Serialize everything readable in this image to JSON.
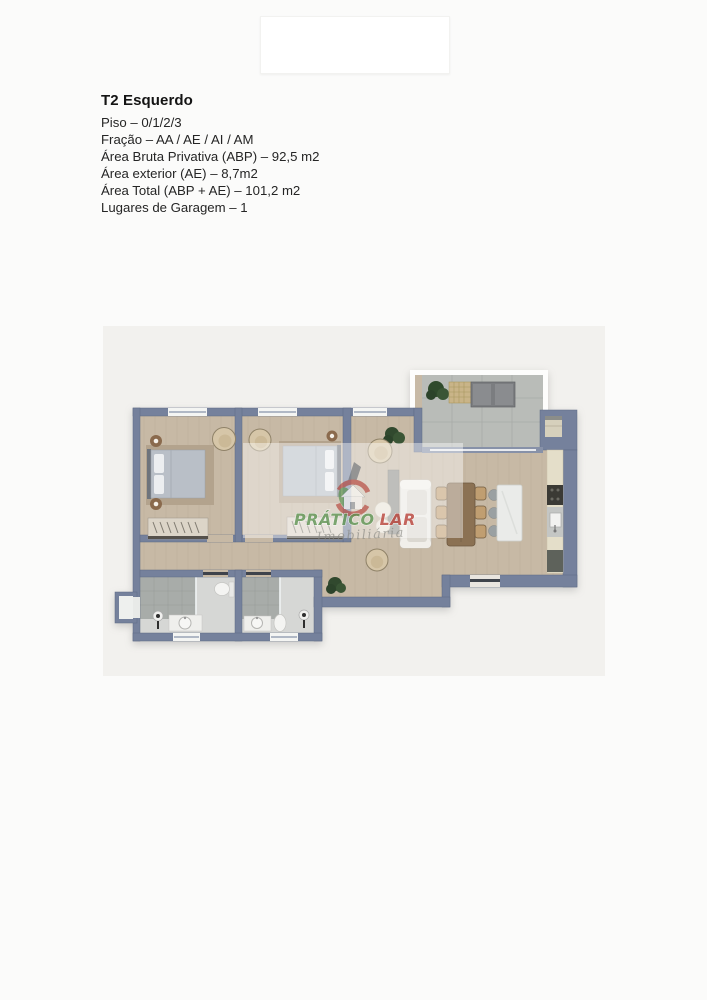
{
  "page": {
    "background": "#fbfbfa"
  },
  "property": {
    "title": "T2 Esquerdo",
    "details": [
      "Piso – 0/1/2/3",
      "Fração – AA / AE / AI / AM",
      "Área Bruta Privativa (ABP) – 92,5 m2",
      "Área exterior (AE) – 8,7m2",
      "Área Total (ABP + AE) – 101,2 m2",
      "Lugares de Garagem – 1"
    ]
  },
  "floor_plan": {
    "watermark": {
      "brand_word1": "PRÁTICO",
      "brand_word2": "LAR",
      "tagline": "Imobiliária",
      "word1_color": "#56904a",
      "word2_color": "#b5372e"
    },
    "colors": {
      "walls": "#75819c",
      "wood_floor": "#c7b9a5",
      "bathroom_tile": "#d6d7d5",
      "balcony_tile": "#b9bcb8"
    }
  }
}
